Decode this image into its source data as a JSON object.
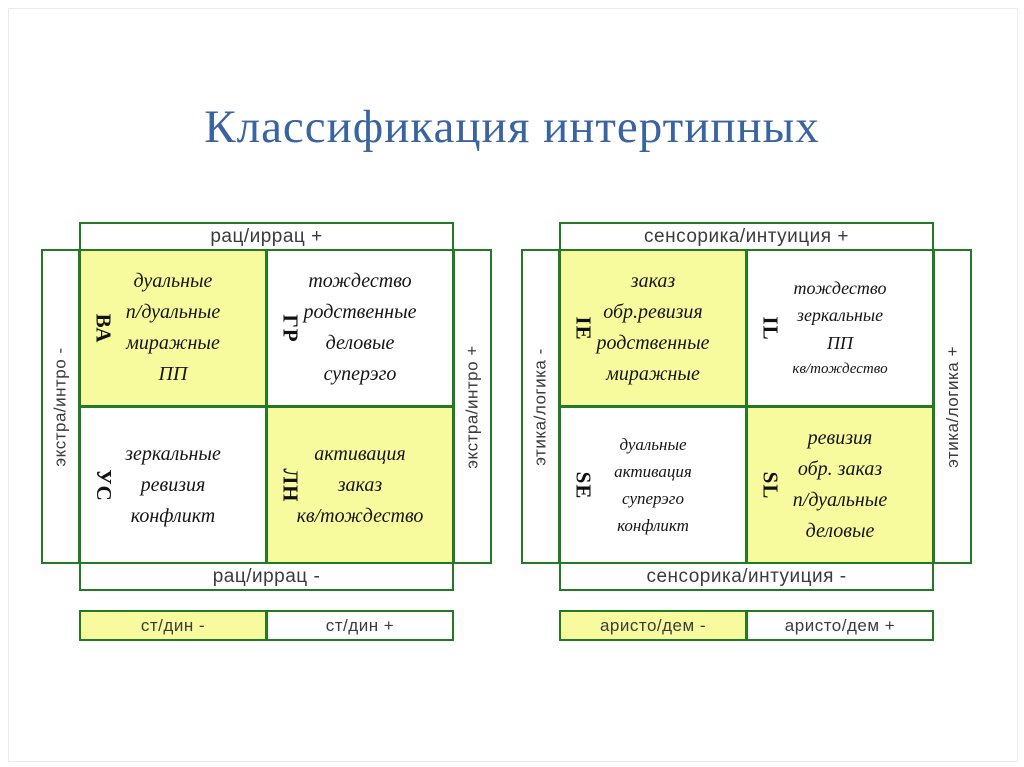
{
  "title": "Классификация интертипных",
  "colors": {
    "border_green": "#227a22",
    "cell_yellow": "#f8fa9e",
    "title_blue": "#3a64a1"
  },
  "diagrams": [
    {
      "top_label": "рац/иррац +",
      "bottom_label": "рац/иррац -",
      "left_label": "экстра/интро -",
      "right_label": "экстра/интро +",
      "quadrants": [
        {
          "code": "ВА",
          "lines": [
            "дуальные",
            "п/дуальные",
            "миражные",
            "ПП"
          ]
        },
        {
          "code": "ГР",
          "lines": [
            "тождество",
            "родственные",
            "деловые",
            "суперэго"
          ]
        },
        {
          "code": "УС",
          "lines": [
            "зеркальные",
            "ревизия",
            "конфликт"
          ]
        },
        {
          "code": "ЛН",
          "lines": [
            "активация",
            "заказ",
            "кв/тождество"
          ]
        }
      ],
      "strip": [
        "ст/дин -",
        "ст/дин +"
      ]
    },
    {
      "top_label": "сенсорика/интуиция +",
      "bottom_label": "сенсорика/интуиция -",
      "left_label": "этика/логика -",
      "right_label": "этика/логика +",
      "quadrants": [
        {
          "code": "IE",
          "lines": [
            "заказ",
            "обр.ревизия",
            "родственные",
            "миражные"
          ]
        },
        {
          "code": "IL",
          "lines": [
            "тождество",
            "зеркальные",
            "ПП",
            "кв/тождество"
          ]
        },
        {
          "code": "SE",
          "lines": [
            "дуальные",
            "активация",
            "суперэго",
            "конфликт"
          ]
        },
        {
          "code": "SL",
          "lines": [
            "ревизия",
            "обр. заказ",
            "п/дуальные",
            "деловые"
          ]
        }
      ],
      "strip": [
        "аристо/дем -",
        "аристо/дем +"
      ]
    }
  ]
}
